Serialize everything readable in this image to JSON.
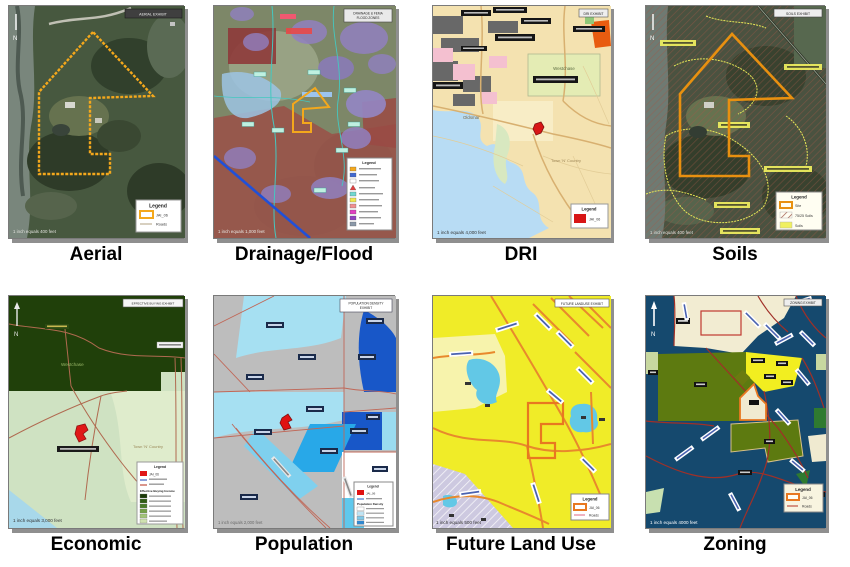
{
  "page": {
    "background": "#ffffff"
  },
  "colors": {
    "parcel_outline": "#F0A41C",
    "site_fill": "#D81616",
    "shadow": "#8F8F8F"
  },
  "maps": [
    {
      "id": "aerial",
      "caption": "Aerial",
      "exhibit_title": "AERIAL EXHIBIT",
      "north_label": "N",
      "scale_text": "1 inch equals 400 feet",
      "legend": {
        "title": "Legend",
        "site_label": "JAI_06",
        "roads_label": "Roads"
      }
    },
    {
      "id": "drainage-flood",
      "caption": "Drainage/Flood",
      "exhibit_title": "DRAINAGE & FEMA",
      "exhibit_title2": "FLOOD ZONES",
      "scale_text": "1 inch equals 1,000 feet",
      "legend": {
        "title": "Legend"
      }
    },
    {
      "id": "dri",
      "caption": "DRI",
      "exhibit_title": "DRI EXHIBIT",
      "scale_text": "1 inch equals 4,000 feet",
      "legend": {
        "title": "Legend",
        "site_label": "JAI_06"
      },
      "place_labels": {
        "westchase": "Westchase",
        "oldsmar": "Oldsmar",
        "town_n_country": "Town 'N' Country"
      }
    },
    {
      "id": "soils",
      "caption": "Soils",
      "exhibit_title": "SOILS EXHIBIT",
      "north_label": "N",
      "scale_text": "1 inch equals 400 feet",
      "legend": {
        "title": "Legend",
        "site_label": "Site",
        "hatch_label": "75/25 Soils",
        "soils_label": "Soils"
      }
    },
    {
      "id": "economic",
      "caption": "Economic",
      "exhibit_title": "EFFECTIVE BUYING EXHIBIT",
      "north_label": "N",
      "scale_text": "1 inch equals 3,000 feet",
      "legend": {
        "title": "Legend",
        "site_label": "JAI_06",
        "income_heading": "Effective Buying Income"
      },
      "place_labels": {
        "westchase": "Westchase",
        "town_n_country": "Town 'N' Country"
      }
    },
    {
      "id": "population",
      "caption": "Population",
      "exhibit_title": "POPULATION DENSITY",
      "exhibit_title2": "EXHIBIT",
      "scale_text": "1 inch equals 2,000 feet",
      "legend": {
        "title": "Legend",
        "site_label": "JAI_06",
        "density_heading": "Population Density"
      }
    },
    {
      "id": "future-land-use",
      "caption": "Future Land Use",
      "exhibit_title": "FUTURE LANDUSE EXHIBIT",
      "scale_text": "1 inch equals 500 feet",
      "legend": {
        "title": "Legend",
        "site_label": "JAI_06",
        "roads_label": "Roads"
      }
    },
    {
      "id": "zoning",
      "caption": "Zoning",
      "exhibit_title": "ZONING EXHIBIT",
      "north_label": "N",
      "scale_text": "1 inch equals 4000 feet",
      "legend": {
        "title": "Legend",
        "site_label": "JAI_06",
        "roads_label": "Roads"
      }
    }
  ]
}
